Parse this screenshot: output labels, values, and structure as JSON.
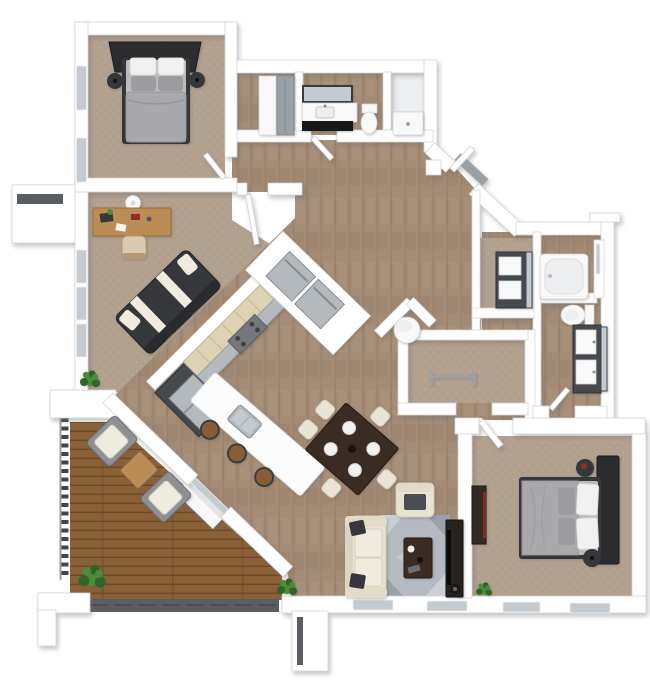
{
  "scene": {
    "kind": "3d-floor-plan-rendering",
    "view": "top-down isometric dollhouse",
    "background": "#ffffff",
    "stories": 1
  },
  "colors": {
    "wall": "#ffffff",
    "wallEdge": "#d4d4d4",
    "carpet": "#b2a08f",
    "carpetDot": "#bcab9b",
    "wood": "#a38b75",
    "woodDark": "#8d7663",
    "woodLight": "#b49c85",
    "deck": "#8a6137",
    "deckDark": "#6b4a26",
    "fascia": "#5a5e63",
    "railing": "#41464b",
    "glass": "#c3cbd1",
    "fixture": "#f8f8f8",
    "fixtureShade": "#eceef0",
    "stainless": "#b4b9be",
    "stainlessDark": "#8f9499",
    "threshold": "#9aa1a6",
    "counterCream": "#ddd2b4",
    "counterCreamEdge": "#c4b894",
    "cabinetDark": "#46494e",
    "stove": "#74787d",
    "island": "#fcfcfc",
    "sofaCream": "#e8e2d3",
    "sofaCreamEdge": "#d2cab7",
    "cushionCream": "#f0ebdf",
    "darkFurn": "#35373b",
    "headboard": "#2c2c2f",
    "bedGray": "#a9a9ab",
    "mattress": "#bbbbbd",
    "pillowWhite": "#f1f1f1",
    "pillowGray": "#9c9c9f",
    "rug": "#b5bac2",
    "rugLight": "#cbd0d7",
    "rugDark": "#9aa1aa",
    "tableBrown": "#3a2b23",
    "chairCream": "#e9e4d6",
    "stoolBrown": "#8a5c33",
    "deskWood": "#bb8c55",
    "deskWoodDark": "#97703f",
    "plant": "#4c8b3a",
    "plantDark": "#2f6527",
    "accentRed": "#8e3026"
  },
  "rooms": [
    {
      "id": "bedroom-2",
      "label": "bedroom",
      "floor": "carpet",
      "furniture": [
        "double bed",
        "headboard",
        "nightstand x2"
      ],
      "windows": 2
    },
    {
      "id": "office-den",
      "label": "den",
      "floor": "carpet",
      "furniture": [
        "desk",
        "desk chair",
        "futon sofa",
        "ceiling fan",
        "plant"
      ],
      "windows": 3
    },
    {
      "id": "hall-closet",
      "label": "closet",
      "floor": "wood",
      "furniture": [
        "sliding doors"
      ]
    },
    {
      "id": "hall-bathroom",
      "label": "bathroom",
      "floor": "wood",
      "furniture": [
        "vanity",
        "mirror",
        "toilet",
        "shower"
      ]
    },
    {
      "id": "hallway",
      "label": "hall",
      "floor": "wood",
      "furniture": [
        "doors"
      ]
    },
    {
      "id": "entry",
      "label": "entry",
      "floor": "wood",
      "furniture": [
        "front door",
        "stoop"
      ]
    },
    {
      "id": "kitchen",
      "label": "kitchen",
      "floor": "wood",
      "furniture": [
        "cabinet run",
        "range",
        "refrigerator",
        "island with sink",
        "bar stool x3",
        "appliance closet"
      ]
    },
    {
      "id": "dining-area",
      "label": "dining",
      "floor": "wood",
      "furniture": [
        "table",
        "chair x5",
        "place setting x4"
      ]
    },
    {
      "id": "living-room",
      "label": "living",
      "floor": "wood",
      "furniture": [
        "sofa",
        "armchair",
        "rug",
        "coffee table",
        "media console",
        "floor lamp",
        "plant x2"
      ],
      "windows": 2
    },
    {
      "id": "utility-closet",
      "label": "utility",
      "floor": "wood",
      "furniture": [
        "water heater"
      ]
    },
    {
      "id": "walk-in-closet",
      "label": "closet",
      "floor": "carpet",
      "furniture": [
        "clothes rack"
      ]
    },
    {
      "id": "dressing-room",
      "label": "dressing",
      "floor": "carpet",
      "furniture": [
        "vanity dresser",
        "mirror"
      ]
    },
    {
      "id": "master-bathroom",
      "label": "bath",
      "floor": "wood",
      "furniture": [
        "bathtub",
        "toilet",
        "double vanity",
        "mirror"
      ]
    },
    {
      "id": "master-bedroom",
      "label": "bedroom",
      "floor": "carpet",
      "furniture": [
        "double bed",
        "headboard",
        "nightstand x2",
        "dresser"
      ],
      "windows": 2
    },
    {
      "id": "balcony-deck",
      "label": "deck",
      "floor": "deck",
      "furniture": [
        "lounge chair x2",
        "side table",
        "plant",
        "railing",
        "sliding door"
      ]
    }
  ],
  "counts": {
    "bottom_windows": 4,
    "plants": 4,
    "bar_stools": 3,
    "dining_chairs": 5,
    "deck_chairs": 2
  }
}
